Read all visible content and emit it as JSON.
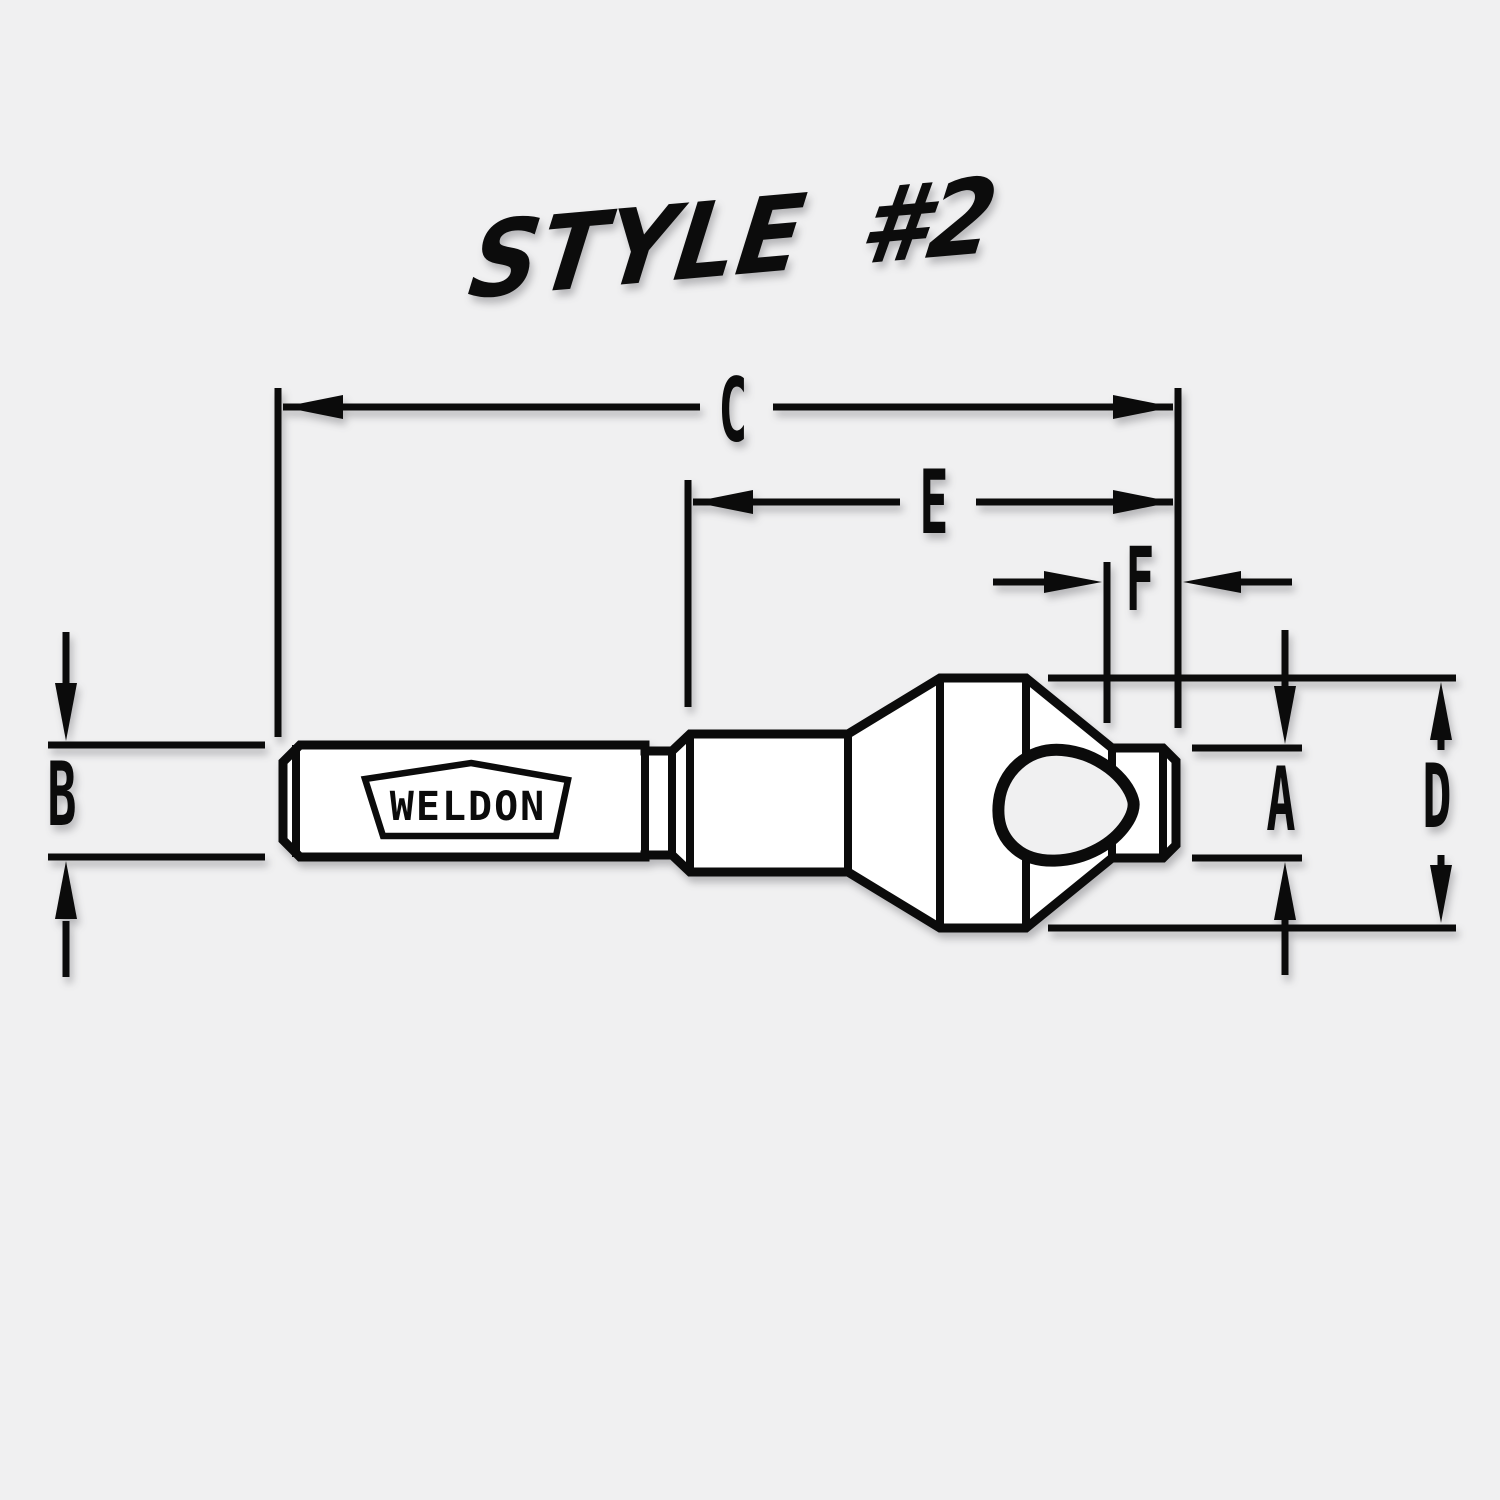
{
  "title": "STYLE #2",
  "drawing": {
    "brand_label": "WELDON",
    "dimension_labels": {
      "C": "C",
      "E": "E",
      "F": "F",
      "B": "B",
      "A": "A",
      "D": "D"
    }
  },
  "colors": {
    "background": "#f0f0f1",
    "ink": "#0b0b0b",
    "part_fill": "#ffffff"
  }
}
